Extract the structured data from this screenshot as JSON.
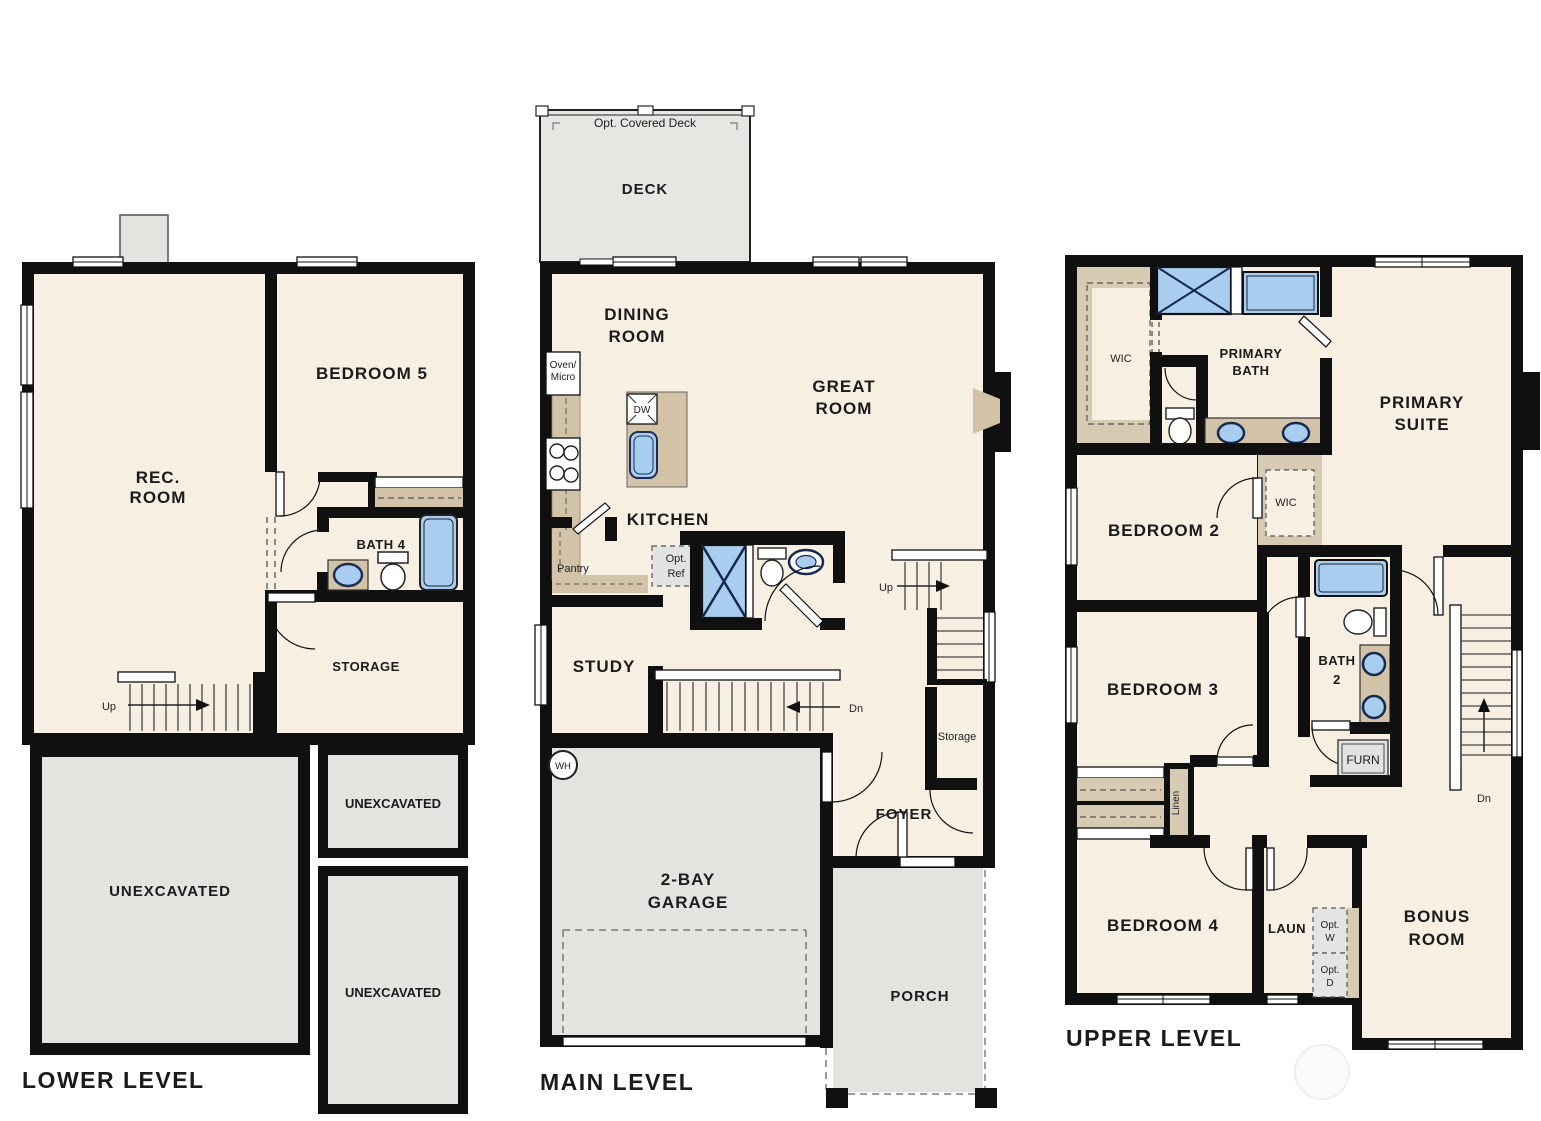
{
  "document": {
    "type": "residential floor plan, three panels"
  },
  "palette": {
    "background": "#ffffff",
    "wall": "#101010",
    "room_fill": "#f7f0e2",
    "exterior_fill": "#e4e3e0",
    "deck_fill": "#e7e6e3",
    "cabinet_tan": "#d2c3a8",
    "closet_tan": "#d7cab2",
    "fixture_blue": "#a9cdef",
    "fixture_stroke": "#1d2e52"
  },
  "levels": {
    "lower": {
      "title": "LOWER LEVEL",
      "rec_room": [
        "REC.",
        "ROOM"
      ],
      "bedroom5": "BEDROOM 5",
      "bath4": "BATH 4",
      "storage": "STORAGE",
      "unexcavated": "UNEXCAVATED",
      "stair_up": "Up"
    },
    "main": {
      "title": "MAIN LEVEL",
      "deck": "DECK",
      "deck_note": "Opt. Covered Deck",
      "dining_room": [
        "DINING",
        "ROOM"
      ],
      "great_room": [
        "GREAT",
        "ROOM"
      ],
      "kitchen": "KITCHEN",
      "oven_micro": [
        "Oven/",
        "Micro"
      ],
      "dishwasher": "DW",
      "pantry": "Pantry",
      "opt_ref": [
        "Opt.",
        "Ref"
      ],
      "study": "STUDY",
      "stair_up": "Up",
      "stair_dn": "Dn",
      "storage": "Storage",
      "foyer": "FOYER",
      "water_heater": "WH",
      "garage": [
        "2-BAY",
        "GARAGE"
      ],
      "porch": "PORCH"
    },
    "upper": {
      "title": "UPPER LEVEL",
      "wic": "WIC",
      "primary_bath": [
        "PRIMARY",
        "BATH"
      ],
      "primary_suite": [
        "PRIMARY",
        "SUITE"
      ],
      "bedroom2": "BEDROOM 2",
      "wic2": "WIC",
      "bath2": [
        "BATH",
        "2"
      ],
      "furnace": "FURN",
      "bedroom3": "BEDROOM 3",
      "linen": "Linen",
      "bedroom4": "BEDROOM 4",
      "laundry": "LAUN",
      "opt_washer": [
        "Opt.",
        "W"
      ],
      "opt_dryer": [
        "Opt.",
        "D"
      ],
      "bonus_room": [
        "BONUS",
        "ROOM"
      ],
      "stair_dn": "Dn"
    }
  }
}
